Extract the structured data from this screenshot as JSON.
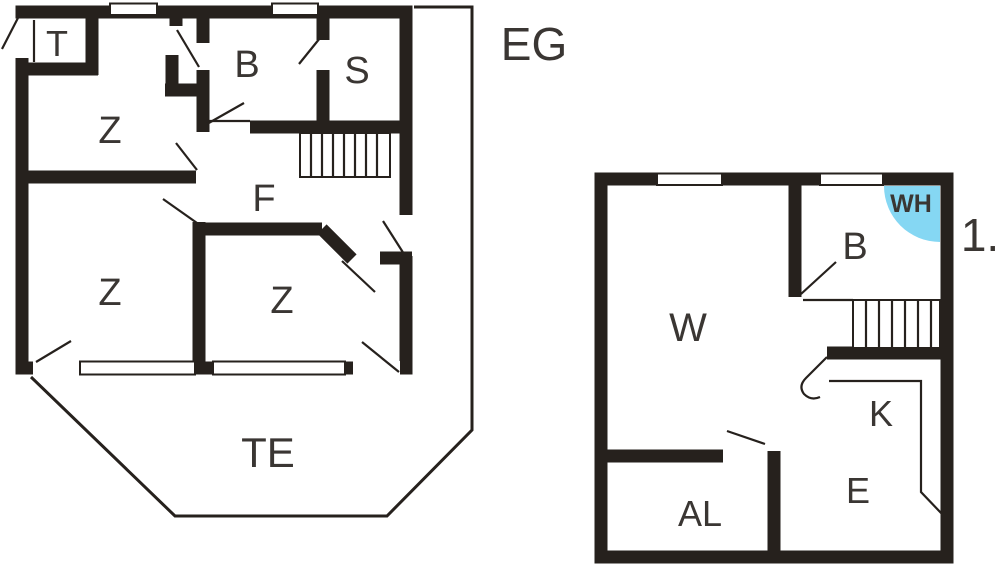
{
  "floors": {
    "eg": {
      "label": "EG",
      "rooms": {
        "t": "T",
        "z_top": "Z",
        "b": "B",
        "s": "S",
        "f": "F",
        "z_left": "Z",
        "z_mid": "Z",
        "te": "TE"
      }
    },
    "og": {
      "label": "1.",
      "rooms": {
        "w": "W",
        "b": "B",
        "wh": "WH",
        "k": "K",
        "e": "E",
        "al": "AL"
      }
    }
  },
  "colors": {
    "wall": "#26211d",
    "label": "#3a3633",
    "wh_fill": "#85d7f3",
    "wh_text": "#1d4164",
    "background": "#ffffff"
  }
}
